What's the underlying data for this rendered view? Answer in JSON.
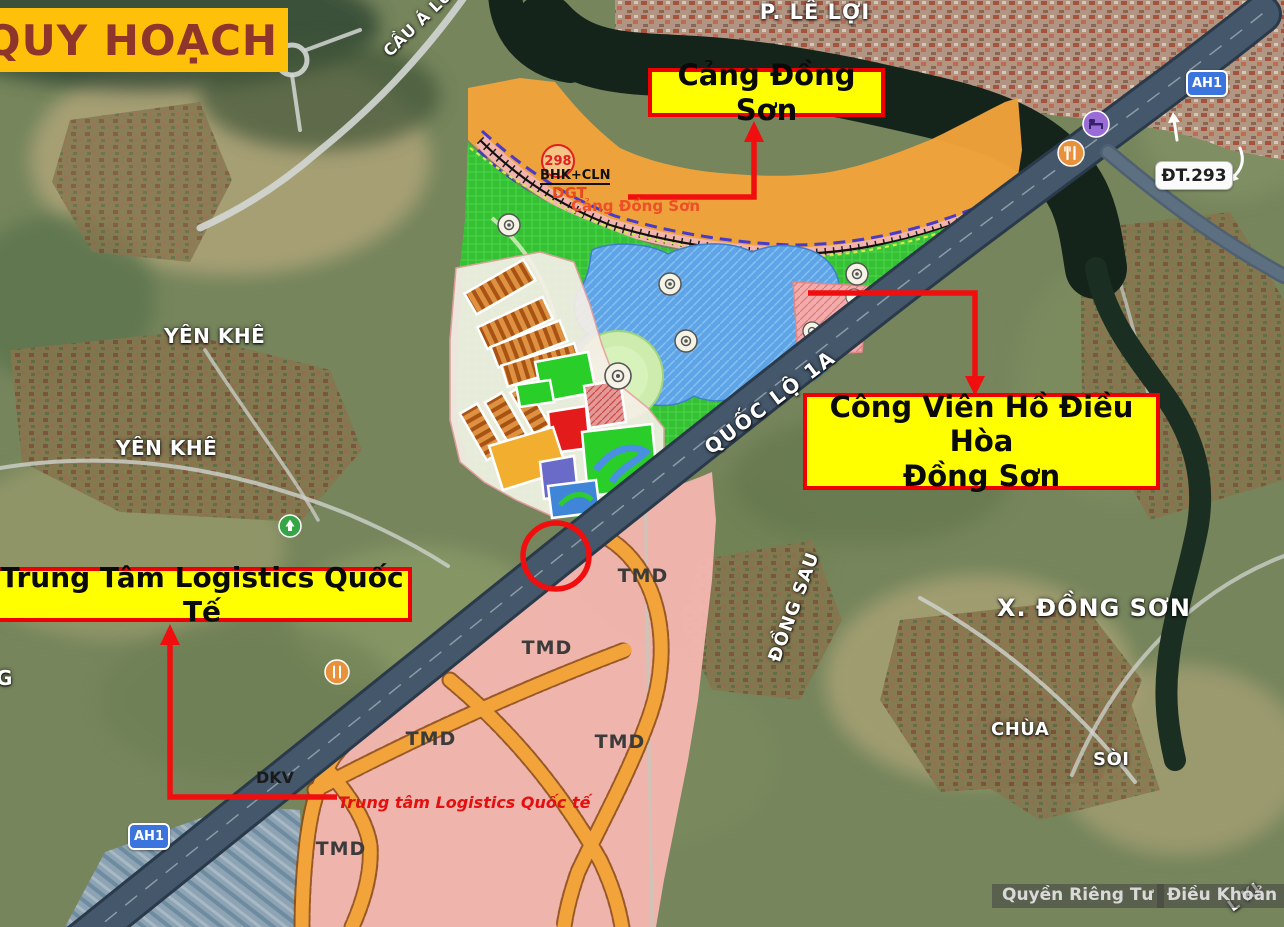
{
  "banner": {
    "title": "QUY HOẠCH"
  },
  "callouts": {
    "port": {
      "label": "Cảng Đồng Sơn"
    },
    "park": {
      "line1": "Công Viên Hồ Điều Hòa",
      "line2": "Đồng Sơn"
    },
    "logistics": {
      "label": "Trung Tâm Logistics Quốc Tế"
    }
  },
  "map_labels": {
    "ward": "P. LÊ LỢI",
    "bridge": "CẦU Á LỮ",
    "yen_khe_upper": "YÊN KHÊ",
    "yen_khe_lower": "YÊN KHÊ",
    "commune": "X. ĐỒNG SƠN",
    "dong_sau": "ĐỒNG SAU",
    "chua": "CHÙA",
    "soi": "SÒI",
    "highway": "QUỐC LỘ 1A",
    "road_fragment": "L KI",
    "edge_fragment": "G"
  },
  "badges": {
    "ah1_top": "AH1",
    "ah1_bottom": "AH1",
    "dt293": "ĐT.293"
  },
  "plan": {
    "circle_number": "298",
    "bhk_cln": "BHK+CLN",
    "dgt": "DGT",
    "port_text": "Cảng Đồng Sơn",
    "logistics_text": "Trung tâm Logistics Quốc tế",
    "dkv": "DKV",
    "tmd": [
      "TMD",
      "TMD",
      "TMD",
      "TMD",
      "TMD"
    ]
  },
  "footer": {
    "privacy": "Quyền Riêng Tư",
    "terms": "Điều Khoản"
  },
  "colors": {
    "callout_bg": "#FFFF00",
    "callout_border": "#EE0000",
    "banner_bg": "#FFC00A",
    "banner_text": "#8E352C",
    "annotation_red": "#EE1111",
    "plan_orange": "#F2A33A",
    "plan_green": "#33C433",
    "plan_pink": "#F4B6B0",
    "lake_blue": "#5FA4E6"
  }
}
